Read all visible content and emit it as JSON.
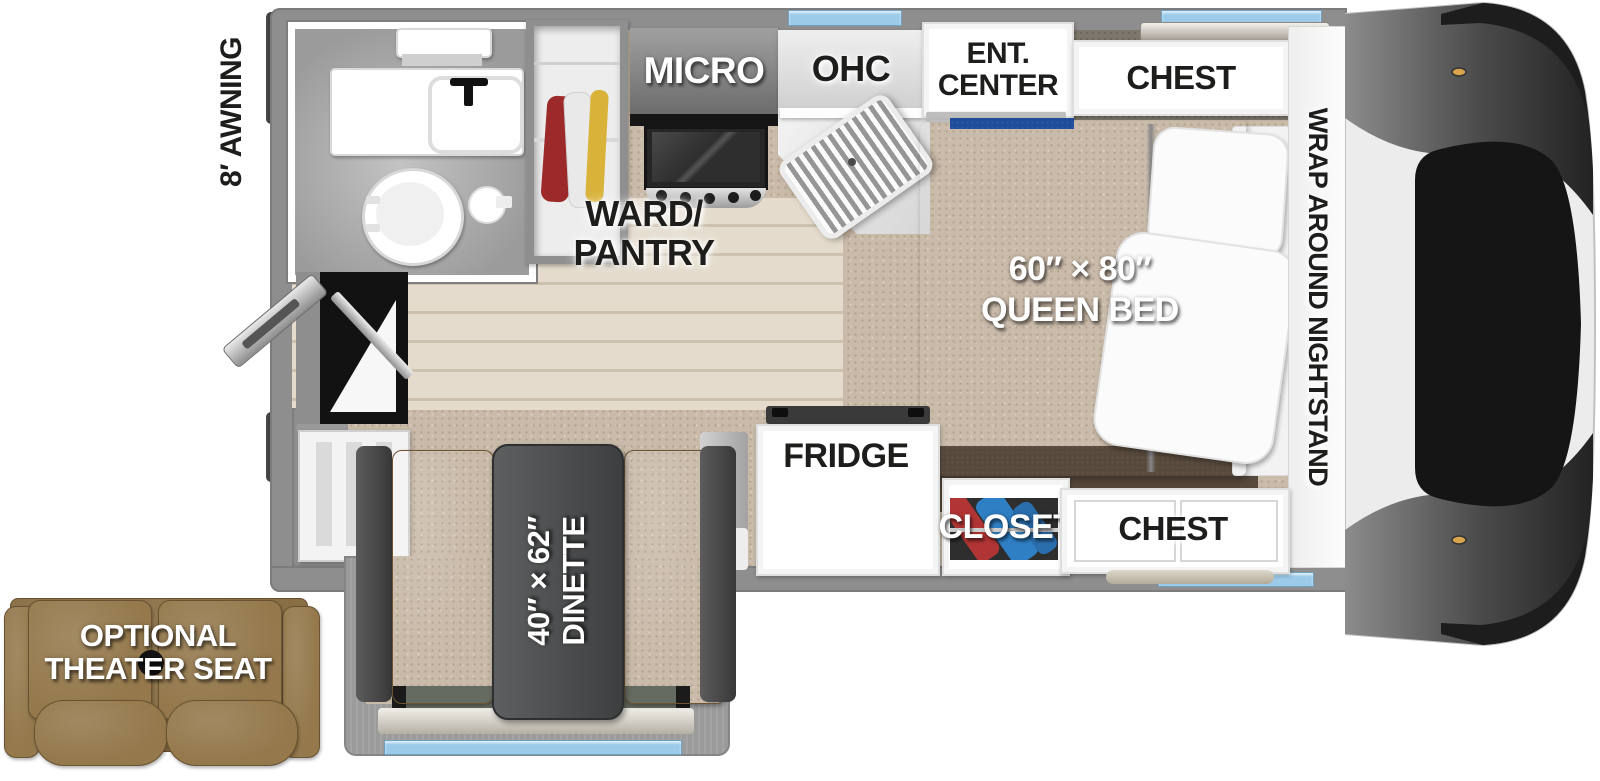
{
  "colors": {
    "wall_gray": "#8e8e8e",
    "carpet_beige": "#c9baa9",
    "wood_floor": "#dcd1c0",
    "window_blue": "#9ccbe9",
    "bed_head_blue": "#1f4d9c",
    "bed_gray": "#a3a3a3",
    "bench_brown": "#8d7147",
    "table_gray": "#4a4c4d",
    "seat_brown": "#8f7550"
  },
  "exterior": {
    "awning_label": "8′ AWNING",
    "theater_seat_line1": "OPTIONAL",
    "theater_seat_line2": "THEATER SEAT"
  },
  "kitchen": {
    "micro_label": "MICRO",
    "ohc_label": "OHC",
    "ward_pantry_line1": "WARD/",
    "ward_pantry_line2": "PANTRY",
    "fridge_label": "FRIDGE"
  },
  "bedroom": {
    "ent_center_line1": "ENT.",
    "ent_center_line2": "CENTER",
    "chest_front_label": "CHEST",
    "nightstand_label": "WRAP AROUND NIGHTSTAND",
    "bed_size": "60″ × 80″",
    "bed_label": "QUEEN BED",
    "closet_label": "CLOSET",
    "chest_rear_label": "CHEST"
  },
  "dinette": {
    "size": "40″ × 62″",
    "label": "DINETTE"
  }
}
